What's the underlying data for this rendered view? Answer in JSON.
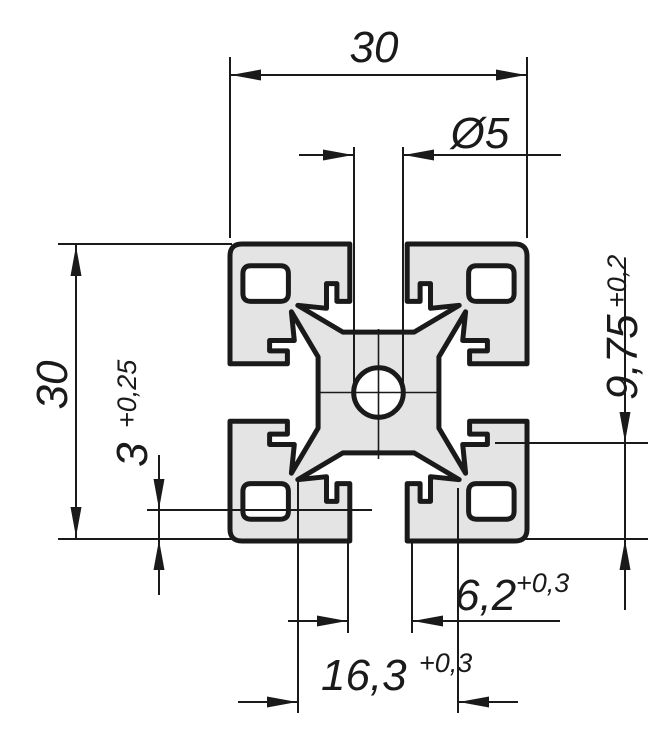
{
  "colors": {
    "background": "#ffffff",
    "material_fill": "#e4e4e4",
    "line": "#1a1a1a"
  },
  "dimensions": {
    "overall_width": {
      "value": "30"
    },
    "overall_height": {
      "value": "30"
    },
    "bore_diameter": {
      "value": "Ø5"
    },
    "slot_lip_height": {
      "value": "3",
      "tolerance": "+0,25"
    },
    "slot_depth": {
      "value": "9,75",
      "tolerance": "+0,2"
    },
    "slot_opening_width": {
      "value": "6,2",
      "tolerance": "+0,3"
    },
    "slot_chamber_width": {
      "value": "16,3",
      "tolerance": "+0,3"
    }
  }
}
